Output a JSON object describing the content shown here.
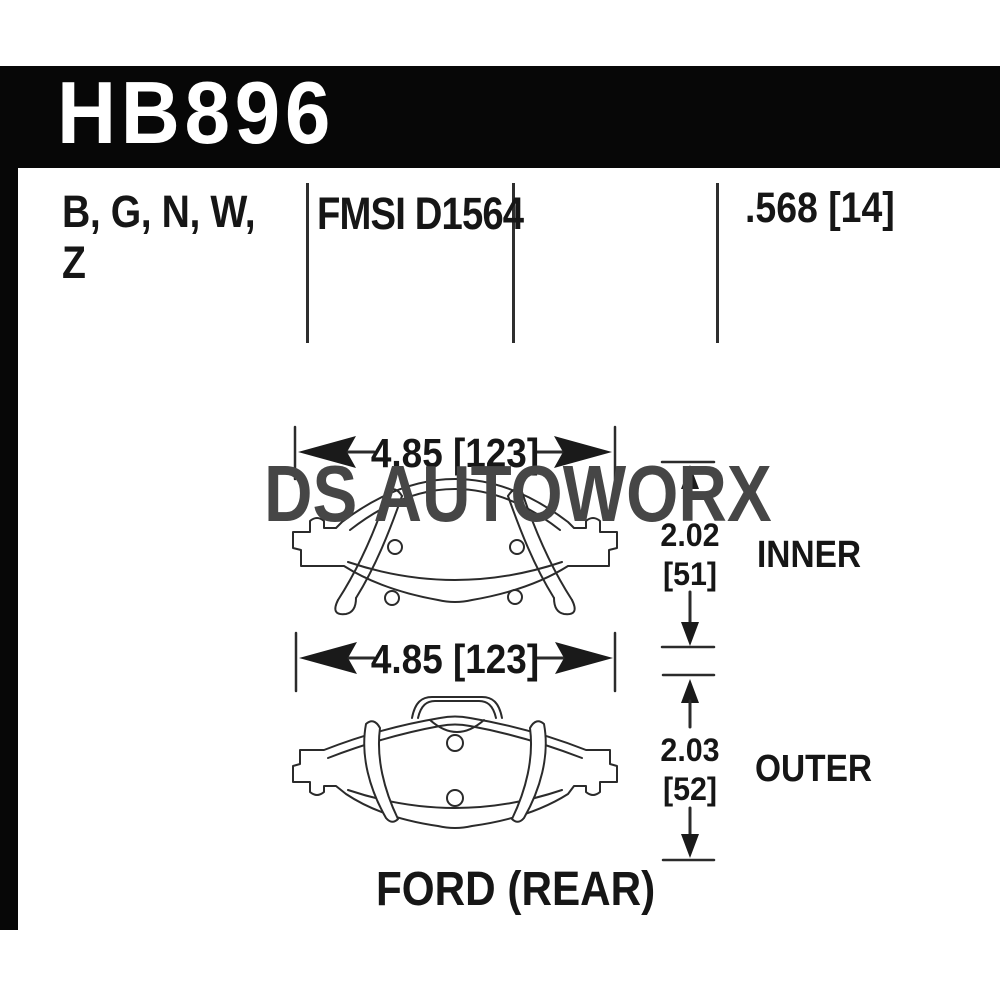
{
  "colors": {
    "header_bar": "#070707",
    "header_text": "#ffffff",
    "body_text": "#161616",
    "line_art": "#2b2b2b",
    "watermark": "#464646",
    "background": "#ffffff"
  },
  "header": {
    "part_number": "HB896"
  },
  "spec_row": {
    "compounds_line1": "B, G, N, W,",
    "compounds_line2": "Z",
    "fmsi": "FMSI D1564",
    "pad_thickness": ".568 [14]"
  },
  "watermark": {
    "text": "DS AUTOWORX"
  },
  "diagram": {
    "width_dim_top": "4.85 [123]",
    "width_dim_bottom": "4.85 [123]",
    "inner_pad": {
      "height_in": "2.02",
      "height_mm": "[51]",
      "label": "INNER"
    },
    "outer_pad": {
      "height_in": "2.03",
      "height_mm": "[52]",
      "label": "OUTER"
    },
    "caption": "FORD (REAR)"
  }
}
